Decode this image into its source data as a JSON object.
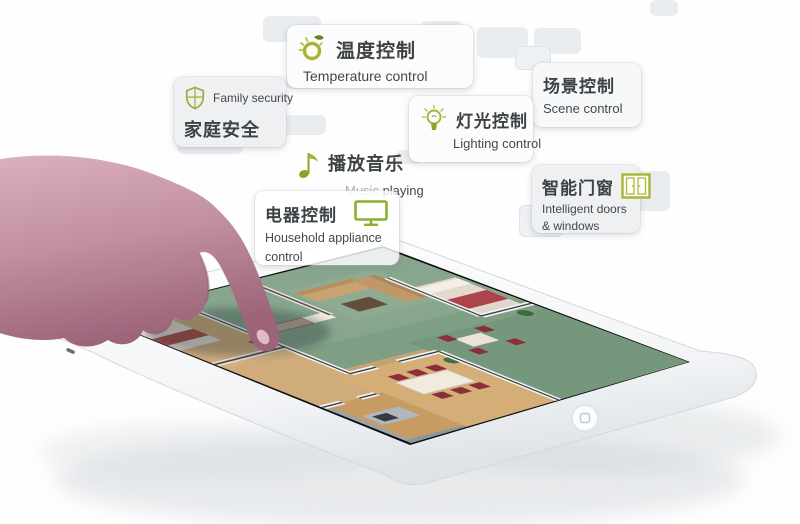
{
  "page": {
    "description": "smart home tablet promo"
  },
  "colors": {
    "accent_green": "#a9b436",
    "text_dark": "#3d4245",
    "text_muted": "#aeb3b6",
    "card_bg": "#f2f4f6",
    "carpet_green": "#7e9f84",
    "chair_red": "#8e2d3a"
  },
  "features": {
    "temperature": {
      "zh": "温度控制",
      "en": "Temperature control"
    },
    "security": {
      "en": "Family security",
      "zh": "家庭安全"
    },
    "scene": {
      "zh": "场景控制",
      "en": "Scene control"
    },
    "lighting": {
      "zh": "灯光控制",
      "en": "Lighting control"
    },
    "music": {
      "zh": "播放音乐",
      "en_muted": "Music",
      "en_bold": " playing"
    },
    "doors": {
      "zh": "智能门窗",
      "en_line1": "Intelligent doors",
      "en_line2": "& windows"
    },
    "appliance": {
      "zh": "电器控制",
      "en_line1": "Household appliance",
      "en_line2": "control"
    }
  }
}
